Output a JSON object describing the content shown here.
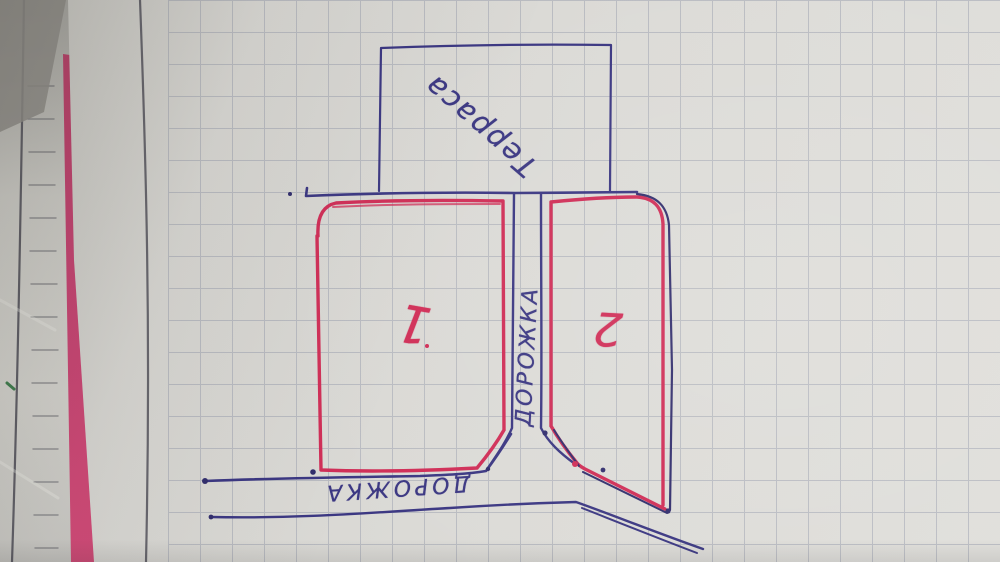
{
  "sketch": {
    "terrace_label": "Терраса",
    "vertical_path_label": "ДОРОЖКА",
    "bottom_path_label": "ДОРОЖКА",
    "plot_left_number": "1",
    "plot_right_number": "2",
    "colors": {
      "red_pen": "#d02e57",
      "blue_pen": "#3b3782",
      "blue_pen_dark": "#322e6d",
      "pink_edge": "#c64372",
      "paper": "#dad9d5",
      "under_paper": "#bdbcb7",
      "grid_line": "#8d93a6",
      "margin_line": "#53525c",
      "under_line": "#5f5e66",
      "green_mark": "#3f7d4e"
    }
  }
}
